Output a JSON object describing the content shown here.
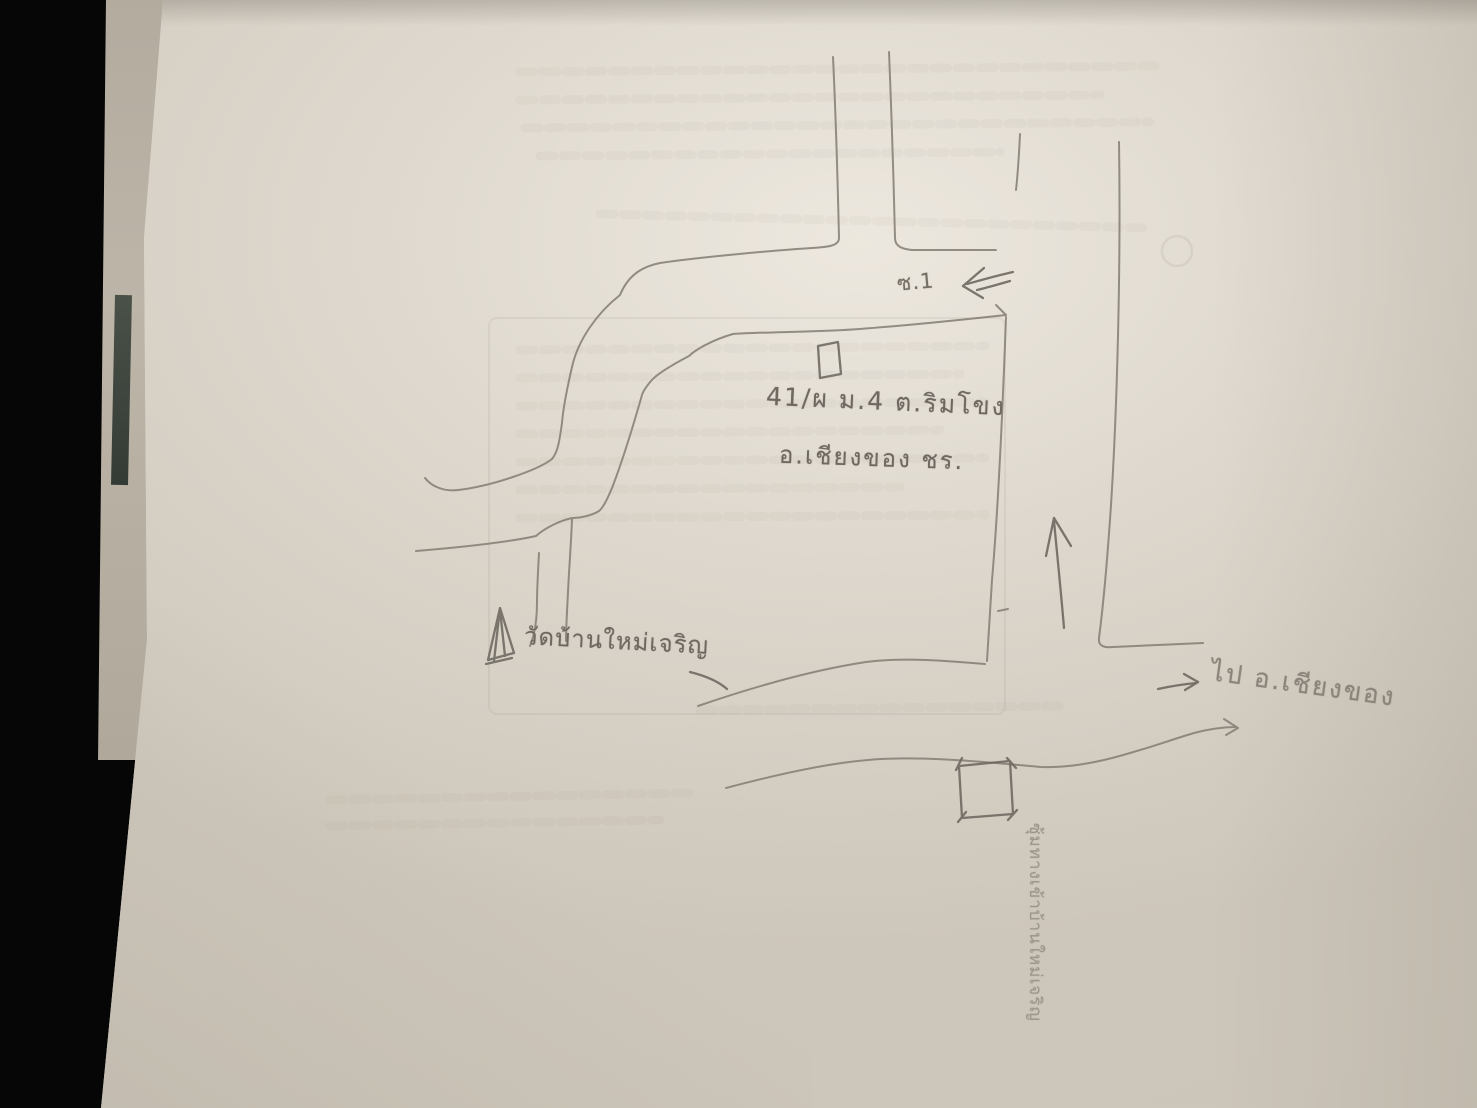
{
  "map": {
    "soi_label": "ซ.1",
    "address_line1": "41/ผ ม.4 ต.ริมโขง",
    "address_line2": "อ.เชียงของ ชร.",
    "temple_label": "วัดบ้านใหม่เจริญ",
    "destination_label": "ไป อ.เชียงของ",
    "gate_label": "ซุ้มทางเข้าบ้านใหม่เจริญ"
  },
  "icons": {
    "house_marker": "open-rectangle",
    "gate_marker": "open-square",
    "temple_marker": "triangle-pennant",
    "up_arrow": "hand-drawn up arrow",
    "left_arrow": "hand-drawn double-stroke left arrow",
    "right_arrow": "hand-drawn right arrow"
  },
  "colors": {
    "background": "#060607",
    "paper": "#d9d3c8",
    "pencil": "#7c766c",
    "back_sheet": "#b7afa2",
    "dark_sliver": "#3f463e"
  }
}
